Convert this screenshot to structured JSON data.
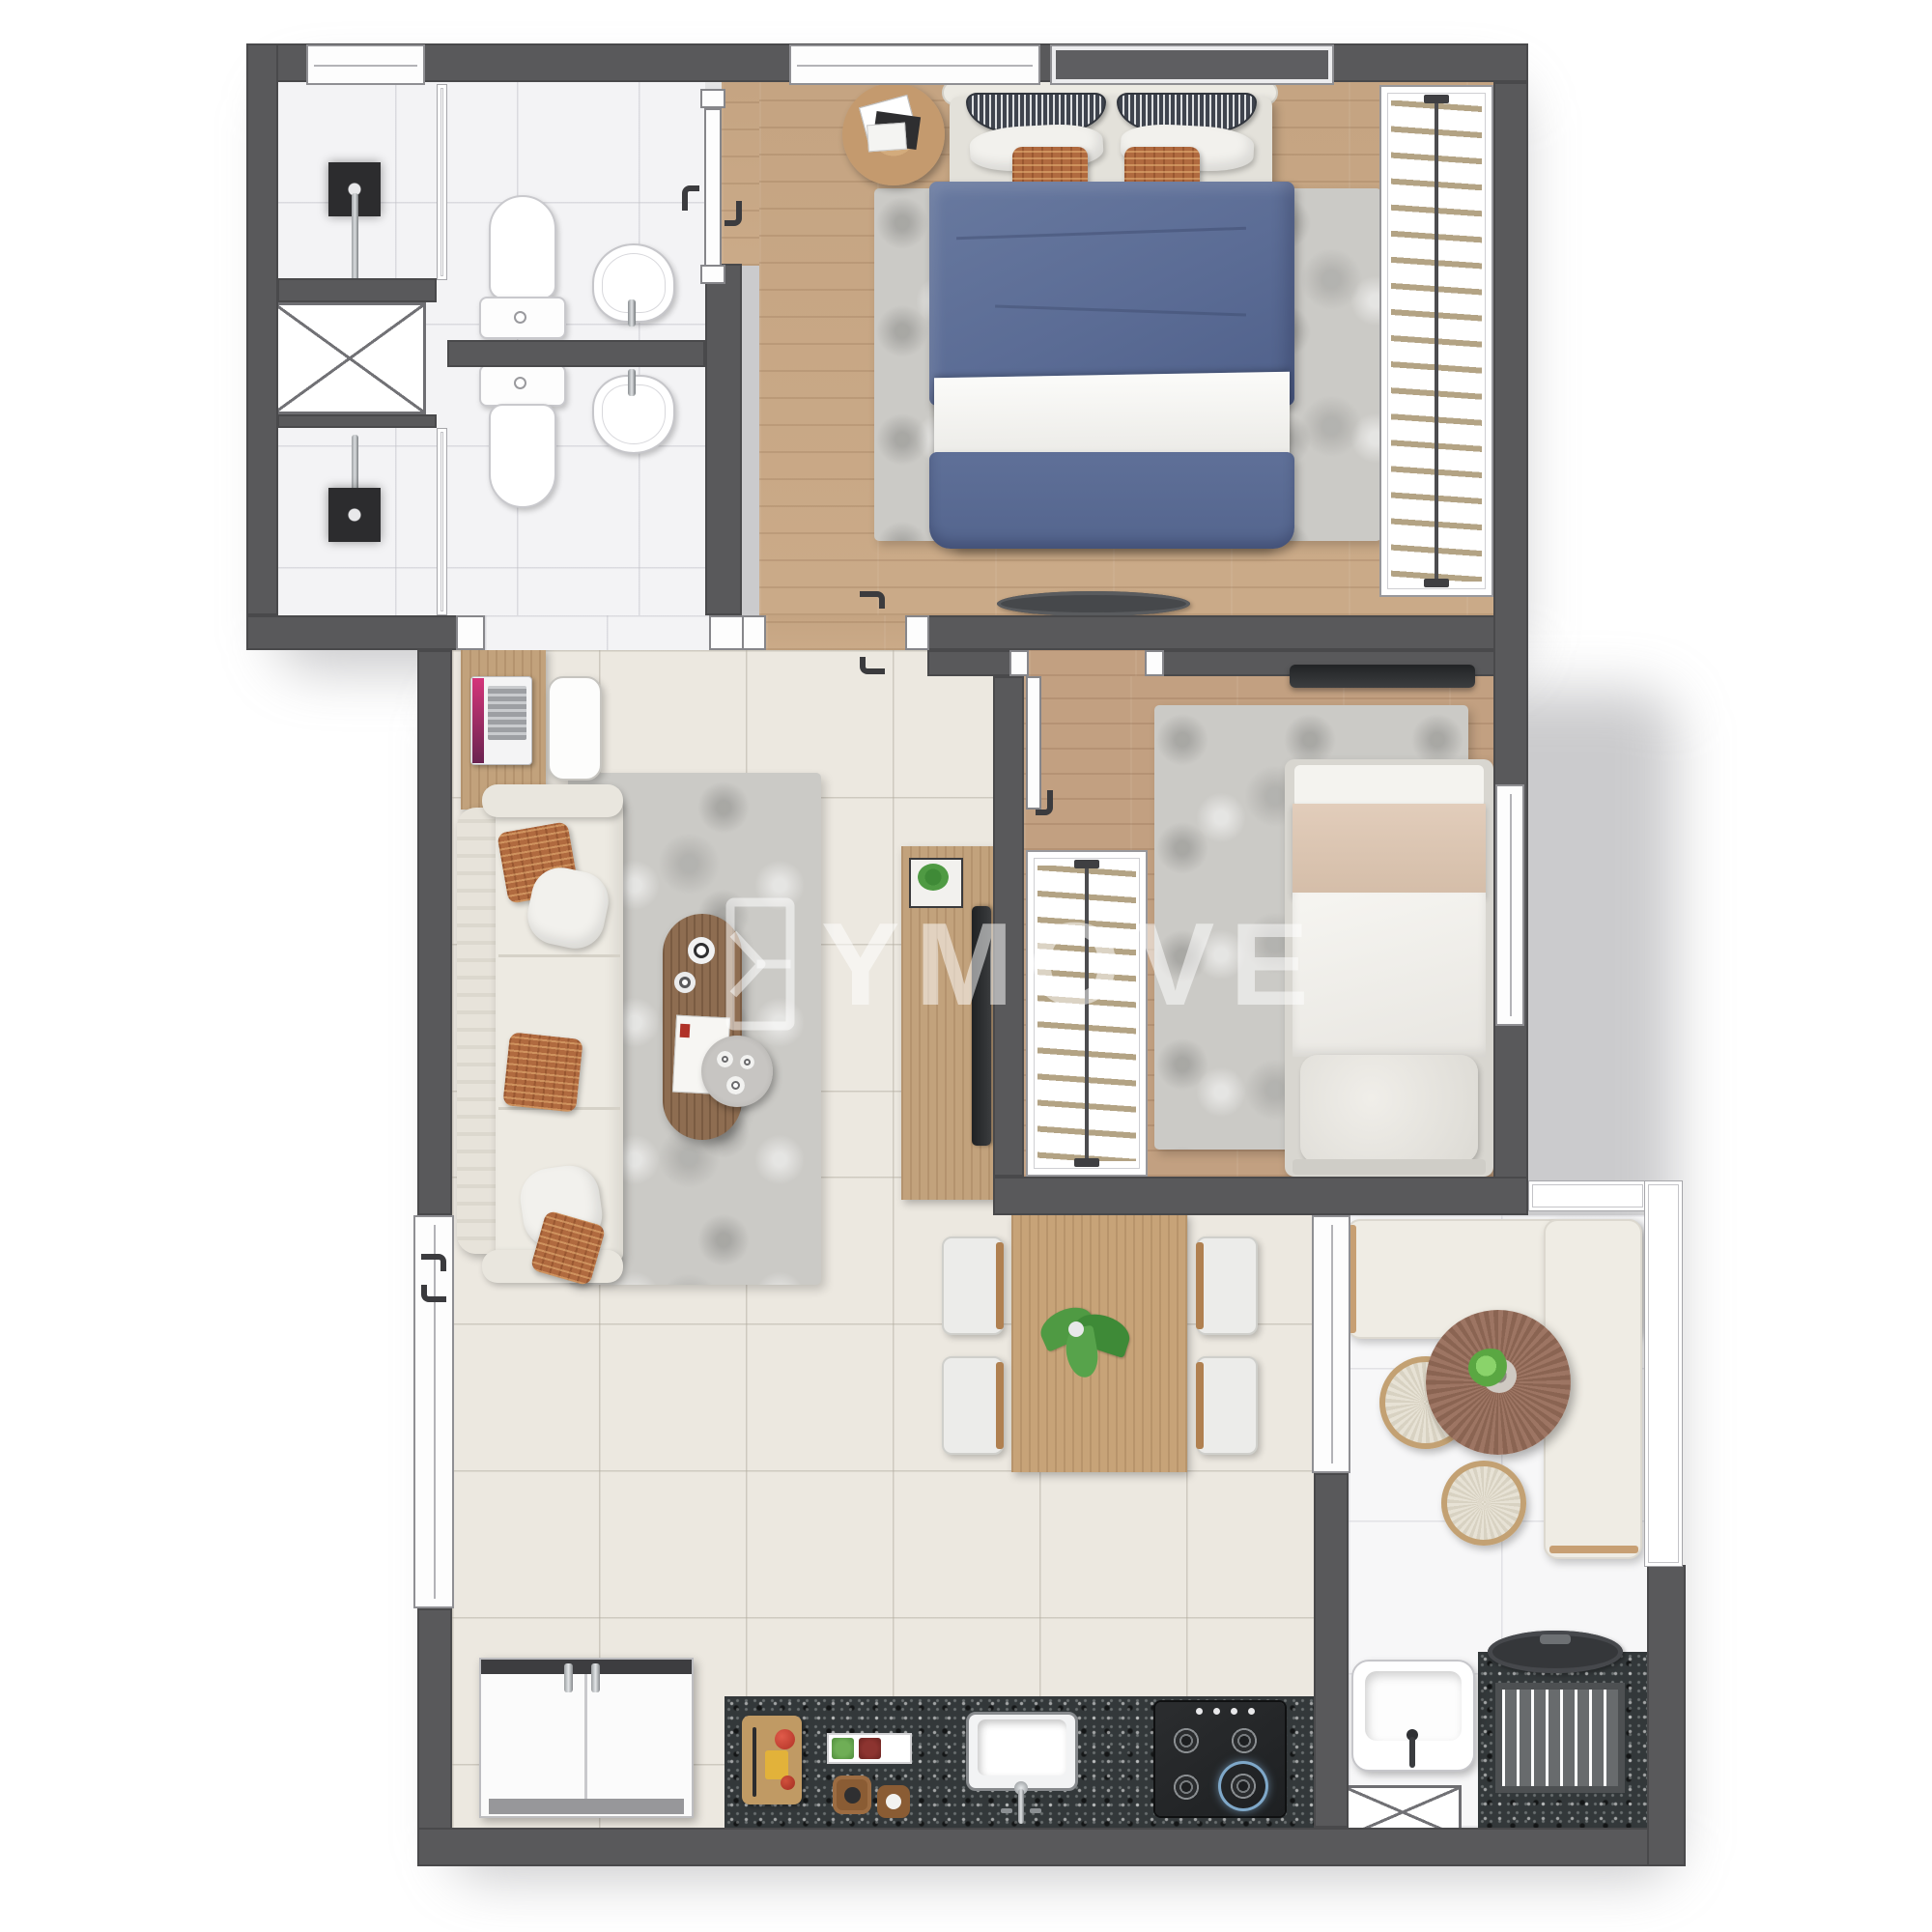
{
  "watermark": {
    "text": "YMOVE",
    "logo": "ymove-bracket-logo",
    "color": "rgba(255,255,255,0.52)"
  },
  "palette": {
    "wall": "#59595B",
    "wood_floor": "#C9A987",
    "wood_furniture": "#C2A27C",
    "tile_floor": "#ECE8E0",
    "bath_tile": "#F3F3F5",
    "balcony_tile": "#F7F7F8",
    "granite_counter": "#33383A",
    "rug_gray": "#CBCAC6",
    "sofa_cream": "#EDEAE2",
    "accent_terracotta": "#B06A3F",
    "bed_blue": "#5B6C95",
    "blanket_beige": "#DCC6B2",
    "plant_green": "#4F9A43"
  },
  "plan": {
    "type": "apartment floor plan (top-down 3D render)",
    "rooms": [
      {
        "name": "bathroom-top",
        "items": [
          "shower",
          "toilet",
          "sink",
          "service-shaft"
        ]
      },
      {
        "name": "bathroom-bottom",
        "items": [
          "shower",
          "toilet",
          "sink"
        ]
      },
      {
        "name": "master-bedroom",
        "items": [
          "double-bed",
          "round-side-table",
          "rug",
          "wardrobe-hangers",
          "tv-bench"
        ]
      },
      {
        "name": "living-room",
        "items": [
          "sofa",
          "desk-with-laptop",
          "lounge-chair",
          "oval-coffee-table",
          "round-tray-table",
          "rug",
          "tv-console"
        ]
      },
      {
        "name": "bedroom-2",
        "items": [
          "single-bed",
          "wardrobe-hangers",
          "rug",
          "wall-tv"
        ]
      },
      {
        "name": "dining-area",
        "items": [
          "wood-table",
          "four-chairs",
          "plant-centerpiece"
        ]
      },
      {
        "name": "kitchen",
        "items": [
          "fridge",
          "granite-counter",
          "cutting-board",
          "condiment-tray",
          "sink",
          "gas-stove"
        ]
      },
      {
        "name": "balcony",
        "items": [
          "l-shaped-bench",
          "round-table-with-plant",
          "two-poufs",
          "glass-railing"
        ]
      },
      {
        "name": "service-area",
        "items": [
          "laundry-sink",
          "washing-machine",
          "shaft"
        ]
      }
    ]
  }
}
